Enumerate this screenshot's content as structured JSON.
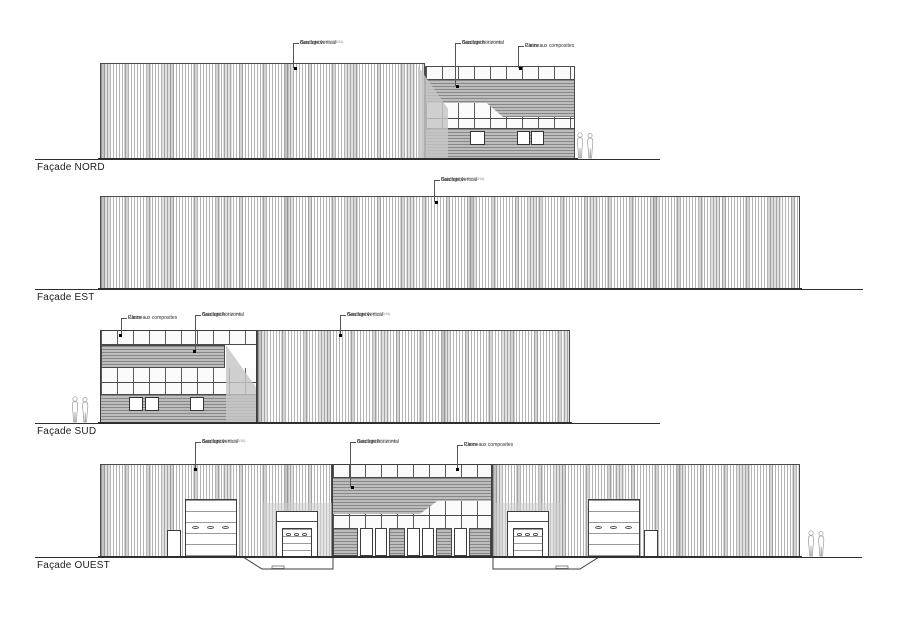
{
  "drawing_type": "architectural-elevations",
  "facades": [
    {
      "id": "nord",
      "label": "Façade NORD"
    },
    {
      "id": "est",
      "label": "Façade EST"
    },
    {
      "id": "sud",
      "label": "Façade SUD"
    },
    {
      "id": "ouest",
      "label": "Façade OUEST"
    }
  ],
  "annotations": {
    "bardage_vertical": {
      "l1": "Bardage vertical",
      "l2": "Gris foncé",
      "l3": "(Type HACIERCO L 87.5/16)"
    },
    "bardage_horizontal": {
      "l1": "Bardage horizontal",
      "l2": "Gris foncé",
      "l3": "(Type HACIERCO 12.5HA)"
    },
    "panneaux_composites": {
      "l1": "Panneaux composites",
      "l2": "Clairs",
      "l3": ""
    }
  },
  "materials": {
    "bardage_vertical_color": "#b5b5b5",
    "bardage_horizontal_color": "#bdbdbd",
    "panneaux_composites_color": "#fafafa",
    "line_color": "#4a4a4a"
  }
}
